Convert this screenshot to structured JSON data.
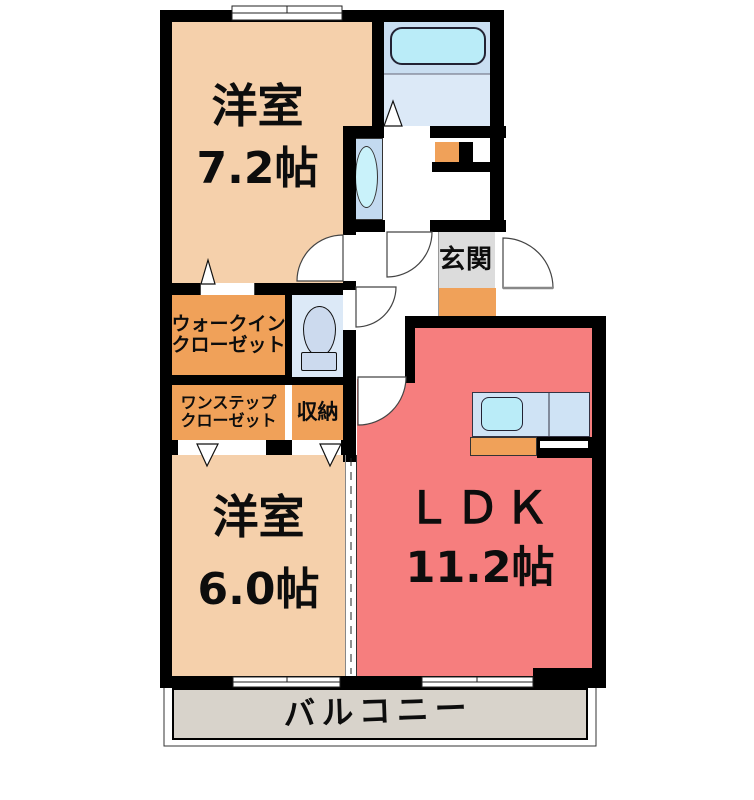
{
  "floorplan": {
    "rooms": {
      "bedroom1": {
        "name": "洋室",
        "size": "7.2帖"
      },
      "bedroom2": {
        "name": "洋室",
        "size": "6.0帖"
      },
      "ldk": {
        "name": "ＬＤＫ",
        "size": "11.2帖"
      },
      "entrance": {
        "name": "玄関"
      },
      "walk_in_closet": {
        "line1": "ウォークイン",
        "line2": "クローゼット"
      },
      "one_step_closet": {
        "line1": "ワンステップ",
        "line2": "クローゼット"
      },
      "storage": {
        "name": "収納"
      },
      "balcony": {
        "name": "バルコニー"
      }
    },
    "fixtures": {
      "bathtub": "bathtub-icon",
      "toilet": "toilet-icon",
      "washbasin": "washbasin-icon",
      "kitchen_sink": "kitchen-sink-icon",
      "washer_pan": "washer-pan-icon"
    },
    "colors": {
      "room_beige": "#f5d0ab",
      "closet_orange": "#f0a159",
      "ldk_red": "#f67e7e",
      "entrance_gray": "#dcdcdc",
      "step_orange": "#f0a159",
      "balcony_gray": "#d8d3cb",
      "bath_upper_blue": "#c9def1",
      "bath_floor_blue": "#dce9f7",
      "tub_cyan": "#baecf8",
      "fixture_blue": "#ccdaee",
      "counter_blue": "#cfe3f5",
      "wall_black": "#000000"
    }
  }
}
